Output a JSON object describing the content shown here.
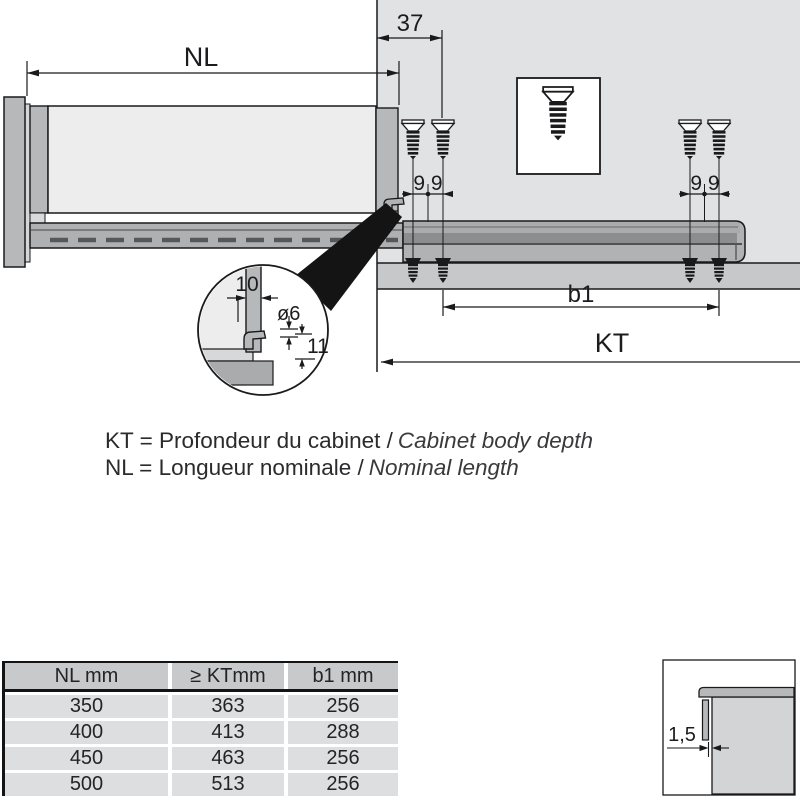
{
  "title": "Drawer runner installation diagram",
  "colors": {
    "outline": "#1a1a1c",
    "cabinet_wall": "#e0e2e4",
    "bottom_band": "#c6c8ca",
    "rail_mid": "#a9abad",
    "rail_dark": "#8b8d8f",
    "rail_light": "#b4b6b8",
    "drawer_side": "#ededee",
    "panel_mid": "#b6b8ba",
    "table_header_bg": "#c7c9cb",
    "table_row_bg": "#dcdee0"
  },
  "dimensions": {
    "nl": "NL",
    "front_offset": "37",
    "screw_spacing_left": "9 9",
    "screw_spacing_right": "9 9",
    "b1": "b1",
    "kt": "KT",
    "detail_width": "10",
    "detail_hole": "ø6",
    "detail_height": "11",
    "gap": "1,5"
  },
  "legend": {
    "line1_fr": "KT = Profondeur du cabinet /",
    "line1_en": "Cabinet body depth",
    "line2_fr": "NL = Longueur nominale /",
    "line2_en": "Nominal length"
  },
  "table": {
    "headers": [
      "NL mm",
      "≥ KTmm",
      "b1 mm"
    ],
    "rows": [
      [
        "350",
        "363",
        "256"
      ],
      [
        "400",
        "413",
        "288"
      ],
      [
        "450",
        "463",
        "256"
      ],
      [
        "500",
        "513",
        "256"
      ]
    ]
  }
}
